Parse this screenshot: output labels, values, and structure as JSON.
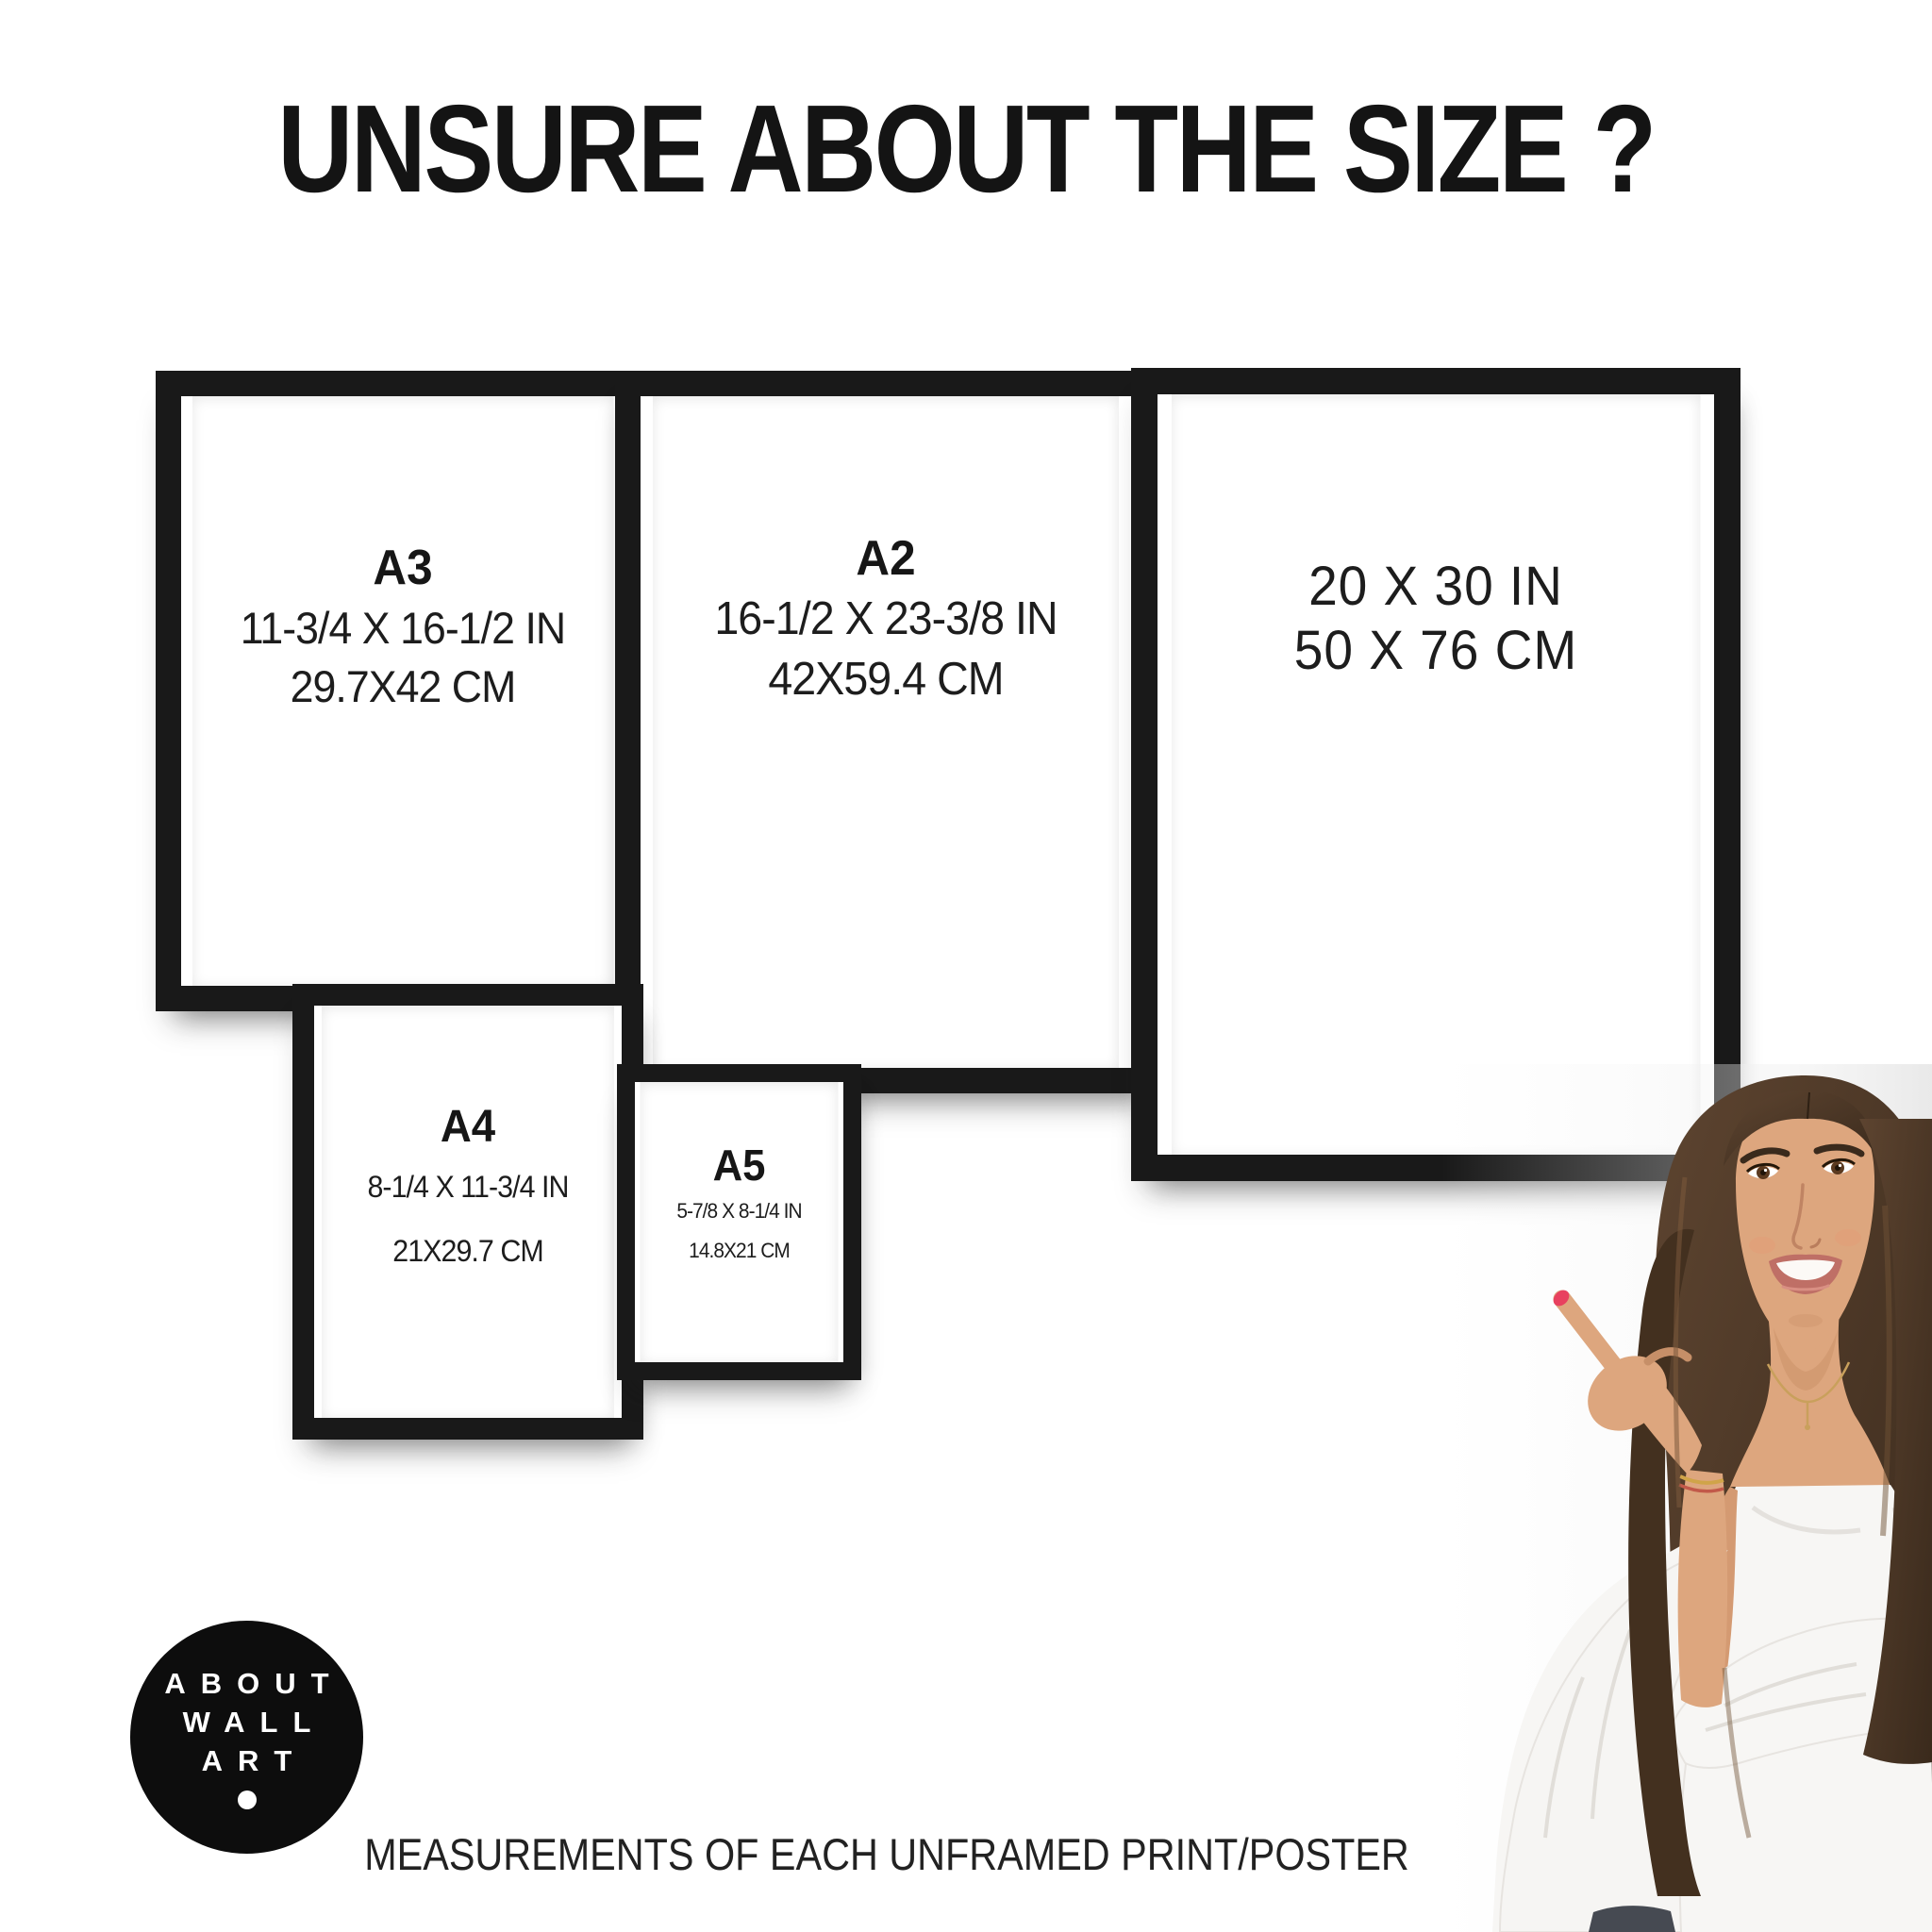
{
  "page": {
    "title": "UNSURE ABOUT THE SIZE ?",
    "caption": "MEASUREMENTS OF EACH UNFRAMED PRINT/POSTER"
  },
  "frames": [
    {
      "label": "A3",
      "inches": "11-3/4 X 16-1/2 IN",
      "cm": "29.7X42 CM"
    },
    {
      "label": "A2",
      "inches": "16-1/2 X 23-3/8 IN",
      "cm": "42X59.4 CM"
    },
    {
      "inches": "20 X 30 IN",
      "cm": "50 X 76 CM"
    },
    {
      "label": "A4",
      "inches": "8-1/4 X 11-3/4 IN",
      "cm": "21X29.7 CM"
    },
    {
      "label": "A5",
      "inches": "5-7/8 X 8-1/4 IN",
      "cm": "14.8X21 CM"
    }
  ],
  "logo": {
    "lines": [
      "ABOUT",
      "WALL",
      "ART"
    ]
  },
  "photo": {
    "alt": "Smiling young woman with long brown hair pointing at the frame size chart"
  },
  "colors": {
    "frame_black": "#191919",
    "text_black": "#1c1c1c",
    "logo_black": "#0d0d0d",
    "nail_red": "#e8415f",
    "hair_brown": "#4b3625",
    "skin": "#dda67e",
    "blouse_white": "#f7f6f4"
  }
}
